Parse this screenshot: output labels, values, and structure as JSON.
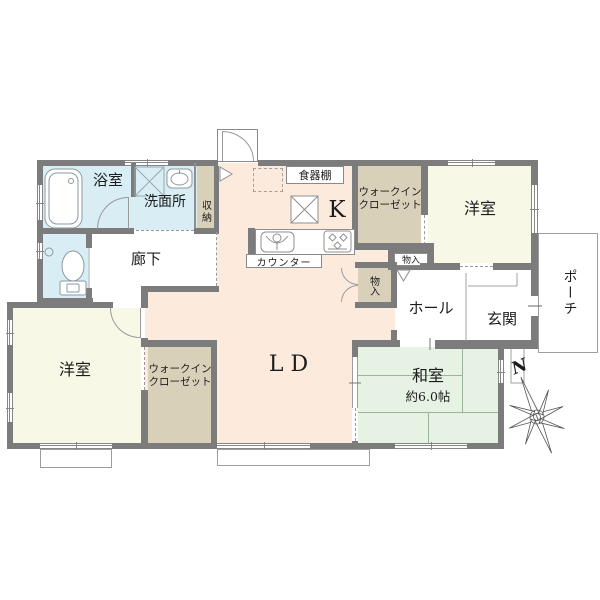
{
  "plan": {
    "title": "floor-plan",
    "rooms": {
      "bath": {
        "label": "浴室"
      },
      "washroom": {
        "label": "洗面所"
      },
      "shuno": {
        "label": "収納"
      },
      "corridor": {
        "label": "廊下"
      },
      "kitchen": {
        "label": "K"
      },
      "cupboard": {
        "label": "食器棚"
      },
      "counter": {
        "label": "カウンター"
      },
      "wic_top": {
        "label": "ウォークイン\nクローゼット"
      },
      "mono_hall": {
        "label": "物入"
      },
      "mono_ld": {
        "label": "物入"
      },
      "yoshitsu_top": {
        "label": "洋室"
      },
      "hall": {
        "label": "ホール"
      },
      "genkan": {
        "label": "玄関"
      },
      "porch": {
        "label": "ポーチ"
      },
      "ld": {
        "label": "LD"
      },
      "washitsu": {
        "label": "和室",
        "size": "約6.0帖"
      },
      "yoshitsu_bottom": {
        "label": "洋室"
      },
      "wic_bottom": {
        "label": "ウォークイン\nクローゼット"
      }
    },
    "compass": {
      "label": "N"
    },
    "colors": {
      "wall": "#7c7c7c",
      "wet_rooms": "#d9edf4",
      "ldk": "#fcebdc",
      "closet": "#d9d0b9",
      "bedroom": "#f8f8e7",
      "tatami": "#e6f2e3",
      "line": "#8a8a8a"
    }
  }
}
